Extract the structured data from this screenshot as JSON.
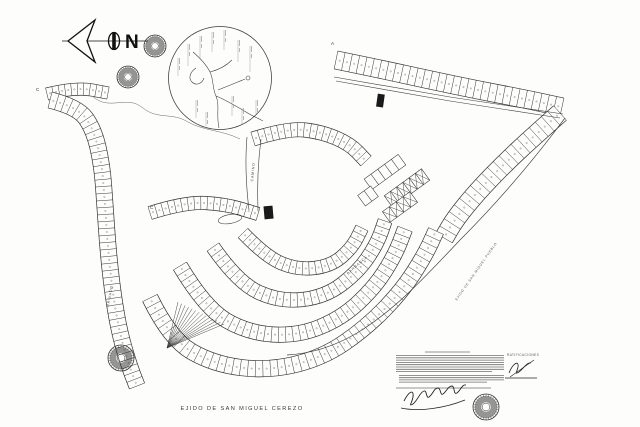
{
  "document": {
    "title": "EJIDO DE SAN MIGUEL CEREZO",
    "notes_heading": "RATIFICACIONES"
  },
  "labels": {
    "north": "N",
    "privado": "PRIVADO",
    "camino": "CAMINO",
    "barranca": "BARRANCA",
    "neighbor_boundary": "EJIDO DE SAN MIGUEL PUEBLO"
  },
  "markers": [
    {
      "label": "A"
    },
    {
      "label": "C"
    },
    {
      "label": "C"
    }
  ],
  "icons": {
    "north_arrow": "north-arrow-icon",
    "seal": "official-seal-stamp"
  },
  "colors": {
    "paper": "#fdfdfb",
    "ink": "#2b2b2b",
    "faint": "#8a8a8a"
  }
}
